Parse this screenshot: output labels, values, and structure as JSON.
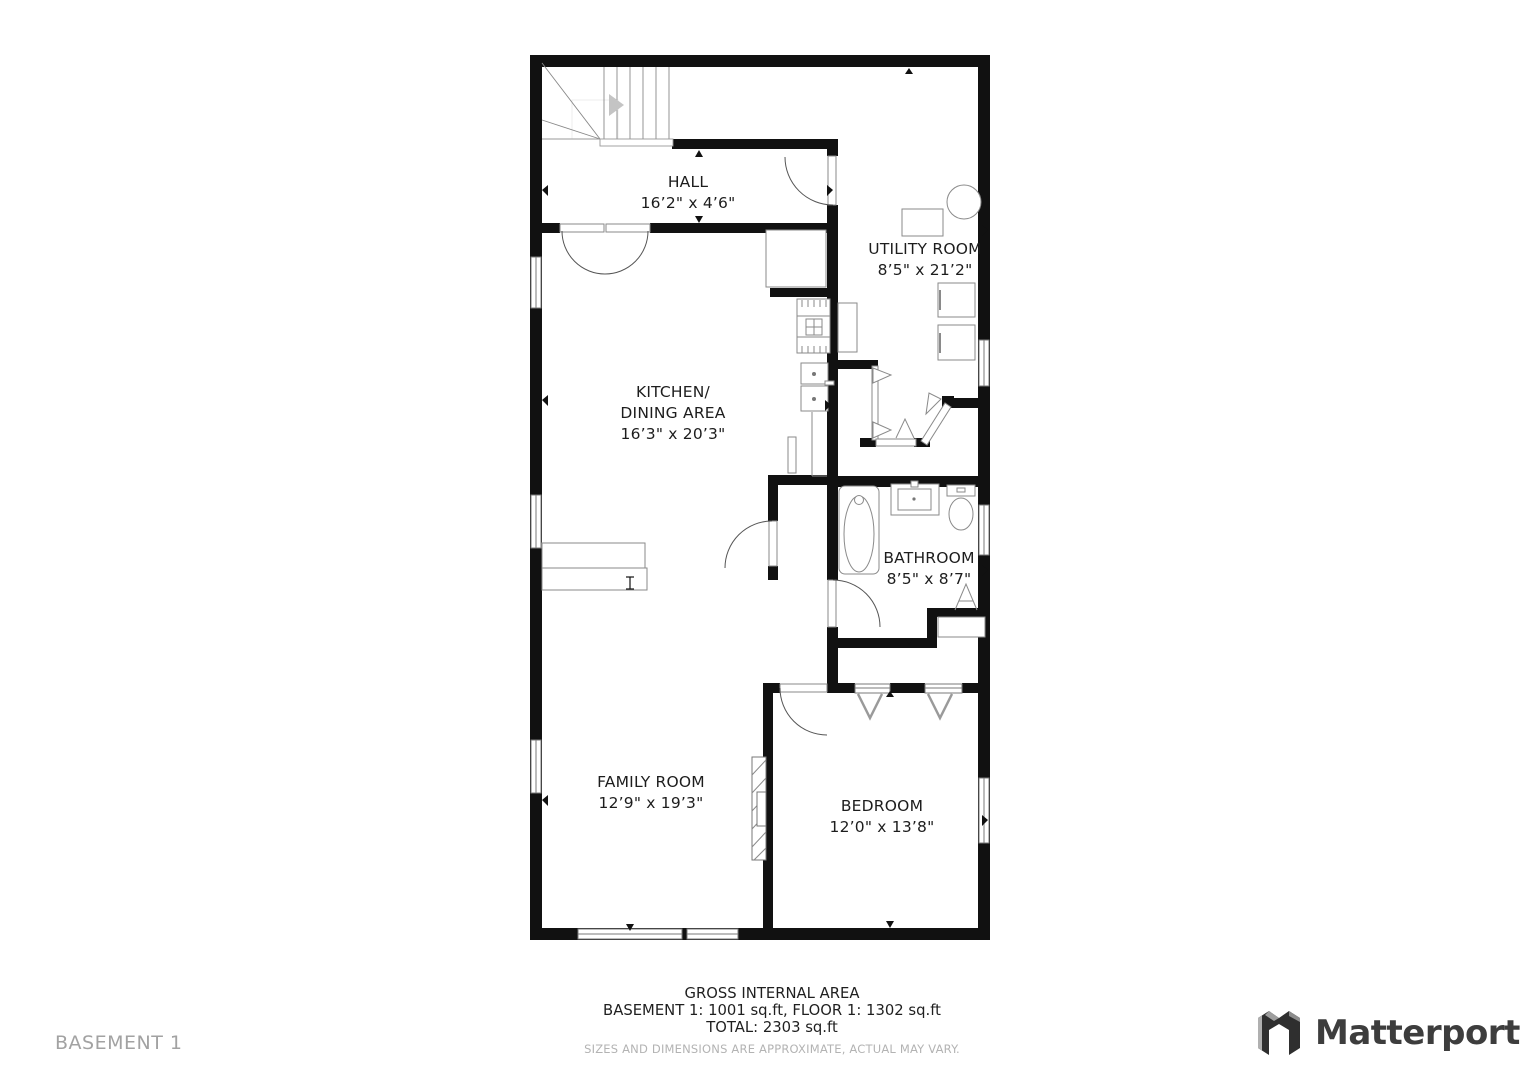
{
  "floor_label": "BASEMENT 1",
  "rooms": [
    {
      "name": "HALL",
      "dims": "16’2\" x 4’6\""
    },
    {
      "name": "UTILITY ROOM",
      "dims": "8’5\" x 21’2\""
    },
    {
      "name": "KITCHEN/",
      "name2": "DINING AREA",
      "dims": "16’3\" x 20’3\""
    },
    {
      "name": "BATHROOM",
      "dims": "8’5\" x 8’7\""
    },
    {
      "name": "FAMILY ROOM",
      "dims": "12’9\" x 19’3\""
    },
    {
      "name": "BEDROOM",
      "dims": "12’0\" x 13’8\""
    }
  ],
  "footer": {
    "title": "GROSS INTERNAL AREA",
    "line1": "BASEMENT 1: 1001 sq.ft, FLOOR 1: 1302 sq.ft",
    "line2": "TOTAL: 2303 sq.ft",
    "disclaimer": "SIZES AND DIMENSIONS ARE APPROXIMATE, ACTUAL MAY VARY."
  },
  "brand": {
    "name": "Matterport"
  },
  "colors": {
    "wall": "#111111",
    "fixture_stroke": "#8a8a8a",
    "label_text": "#1d1d1d",
    "muted_text": "#b3b3b3",
    "brand_text": "#3d3d3d"
  }
}
